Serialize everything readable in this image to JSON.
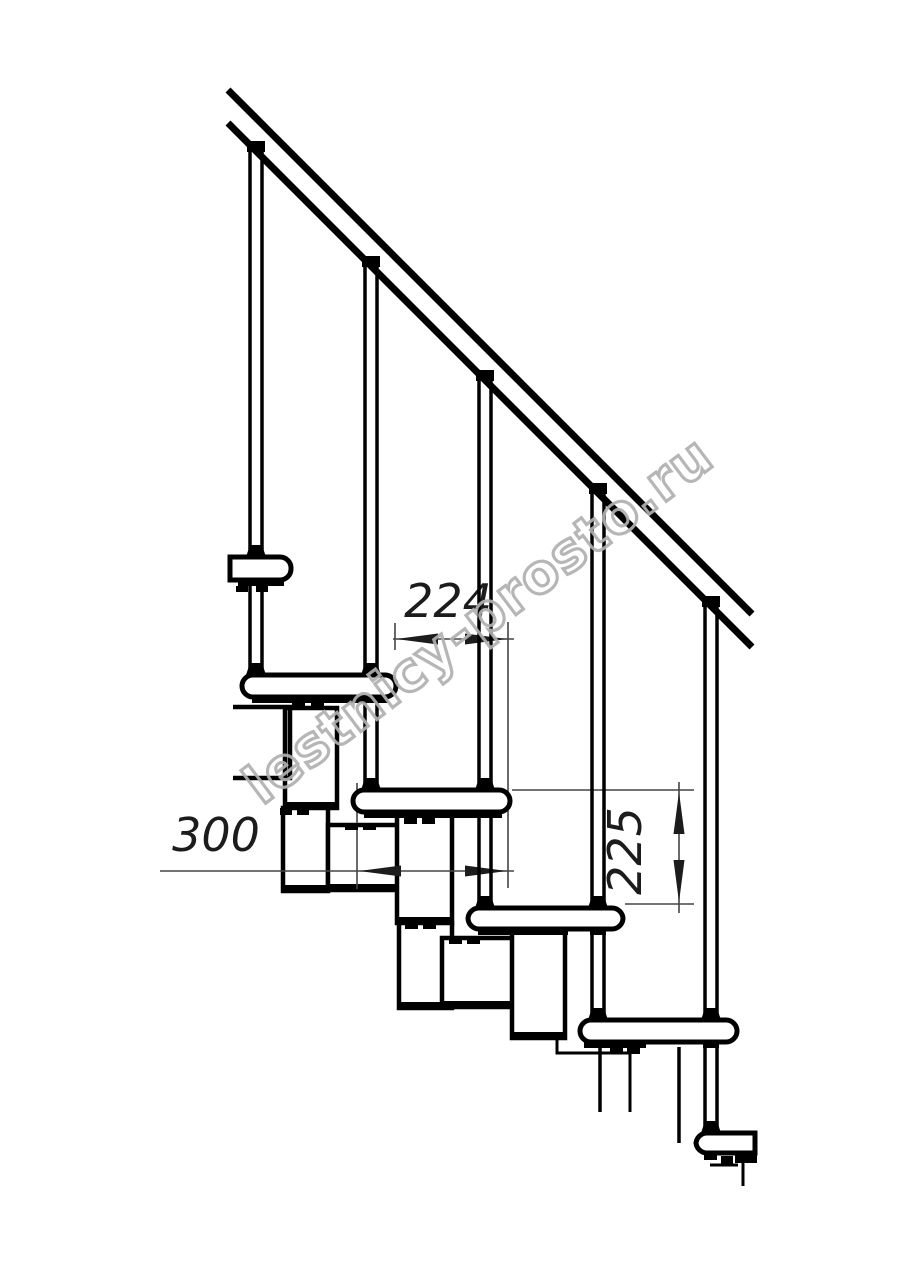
{
  "page": {
    "background": "#ffffff",
    "line_color": "#000000",
    "dim_line_color": "#454545",
    "description": "Side-view technical drawing of a modular staircase with handrail, balusters, treads and support modules"
  },
  "watermark": {
    "text": "lestnicy-prosto.ru",
    "color": "#b0b0b0",
    "x": 262,
    "y": 806,
    "angle_deg": -37,
    "font_size": 54
  },
  "dimensions": [
    {
      "id": "dim-224",
      "label": "224",
      "orientation": "horizontal",
      "text_x": 448,
      "text_y": 617,
      "rotate": 0,
      "lines": [
        [
          393,
          639,
          514,
          639
        ]
      ],
      "ext": [
        [
          395,
          623,
          395,
          650
        ],
        [
          508,
          622,
          508,
          888
        ]
      ],
      "arrows": [
        {
          "x": 396,
          "y": 639,
          "dir": "left"
        },
        {
          "x": 507,
          "y": 639,
          "dir": "right"
        }
      ]
    },
    {
      "id": "dim-300",
      "label": "300",
      "orientation": "horizontal",
      "text_x": 216,
      "text_y": 851,
      "rotate": 0,
      "lines": [
        [
          160,
          871,
          514,
          871
        ]
      ],
      "ext": [
        [
          357,
          783,
          357,
          889
        ]
      ],
      "arrows": [
        {
          "x": 359,
          "y": 871,
          "dir": "left"
        },
        {
          "x": 507,
          "y": 871,
          "dir": "right"
        }
      ]
    },
    {
      "id": "dim-225",
      "label": "225",
      "orientation": "vertical",
      "text_x": 641,
      "text_y": 851,
      "rotate": -90,
      "lines": [
        [
          679,
          782,
          679,
          913
        ]
      ],
      "ext": [
        [
          512,
          790,
          694,
          790
        ],
        [
          625,
          904,
          694,
          904
        ]
      ],
      "arrows": [
        {
          "x": 679,
          "y": 792,
          "dir": "up"
        },
        {
          "x": 679,
          "y": 902,
          "dir": "down"
        }
      ]
    }
  ],
  "drawing": {
    "rail": {
      "x1": 228,
      "y_top1": 90,
      "x2": 752,
      "y_top2": 614,
      "band_offset": 33,
      "stroke": 7
    },
    "balusters": [
      {
        "axis": 256,
        "rail_y": 151,
        "seg1_bot": 557,
        "seg2_top": 580,
        "seg2_bot": 675
      },
      {
        "axis": 371,
        "rail_y": 266,
        "seg1_bot": 675,
        "seg2_top": 697,
        "seg2_bot": 790
      },
      {
        "axis": 485,
        "rail_y": 380,
        "seg1_bot": 790,
        "seg2_top": 812,
        "seg2_bot": 908
      },
      {
        "axis": 598,
        "rail_y": 493,
        "seg1_bot": 908,
        "seg2_top": 929,
        "seg2_bot": 1020
      },
      {
        "axis": 711,
        "rail_y": 606,
        "seg1_bot": 1020,
        "seg2_top": 1042,
        "seg2_bot": 1133
      }
    ],
    "treads": [
      {
        "x": 230,
        "y": 557,
        "w": 61,
        "h": 23,
        "round": "right"
      },
      {
        "x": 242,
        "y": 675,
        "w": 154,
        "h": 22,
        "round": "both"
      },
      {
        "x": 353,
        "y": 790,
        "w": 157,
        "h": 22,
        "round": "both"
      },
      {
        "x": 468,
        "y": 908,
        "w": 155,
        "h": 21,
        "round": "both"
      },
      {
        "x": 580,
        "y": 1020,
        "w": 157,
        "h": 22,
        "round": "both"
      },
      {
        "x": 696,
        "y": 1133,
        "w": 59,
        "h": 20,
        "round": "left"
      }
    ],
    "modules": [
      {
        "x": 285,
        "y": 708,
        "w": 52,
        "h": 100
      },
      {
        "x": 283,
        "y": 808,
        "w": 45,
        "h": 83
      },
      {
        "x": 328,
        "y": 825,
        "w": 75,
        "h": 65
      },
      {
        "x": 397,
        "y": 815,
        "w": 55,
        "h": 108
      },
      {
        "x": 399,
        "y": 923,
        "w": 53,
        "h": 85
      },
      {
        "x": 442,
        "y": 938,
        "w": 76,
        "h": 69
      },
      {
        "x": 512,
        "y": 932,
        "w": 53,
        "h": 106
      }
    ],
    "open_paths": [
      {
        "pts": [
          [
            233,
            707
          ],
          [
            290,
            707
          ],
          [
            290,
            778
          ],
          [
            233,
            778
          ]
        ],
        "stroke": 4.5
      },
      {
        "pts": [
          [
            557,
            1040
          ],
          [
            557,
            1053
          ],
          [
            630,
            1053
          ],
          [
            630,
            1112
          ]
        ],
        "stroke": 3
      },
      {
        "pts": [
          [
            600,
            1047
          ],
          [
            600,
            1112
          ]
        ],
        "stroke": 3.5
      },
      {
        "pts": [
          [
            679,
            1047
          ],
          [
            679,
            1143
          ]
        ],
        "stroke": 3.5
      },
      {
        "pts": [
          [
            710,
            1165
          ],
          [
            738,
            1165
          ]
        ],
        "stroke": 3
      },
      {
        "pts": [
          [
            743,
            1163
          ],
          [
            743,
            1186
          ]
        ],
        "stroke": 3
      }
    ],
    "bands": [
      {
        "x": 238,
        "y": 580,
        "w": 46,
        "h": 6
      },
      {
        "x": 252,
        "y": 697,
        "w": 136,
        "h": 6
      },
      {
        "x": 364,
        "y": 812,
        "w": 138,
        "h": 6
      },
      {
        "x": 478,
        "y": 929,
        "w": 90,
        "h": 6
      },
      {
        "x": 584,
        "y": 1042,
        "w": 62,
        "h": 6
      },
      {
        "x": 735,
        "y": 1152,
        "w": 22,
        "h": 11
      }
    ],
    "nubs": [
      {
        "x": 236,
        "y": 586,
        "w": 12,
        "h": 6
      },
      {
        "x": 256,
        "y": 586,
        "w": 12,
        "h": 6
      },
      {
        "x": 292,
        "y": 703,
        "w": 13,
        "h": 6
      },
      {
        "x": 311,
        "y": 703,
        "w": 13,
        "h": 6
      },
      {
        "x": 280,
        "y": 808,
        "w": 12,
        "h": 7
      },
      {
        "x": 297,
        "y": 808,
        "w": 12,
        "h": 7
      },
      {
        "x": 345,
        "y": 823,
        "w": 13,
        "h": 7
      },
      {
        "x": 363,
        "y": 823,
        "w": 13,
        "h": 7
      },
      {
        "x": 404,
        "y": 818,
        "w": 13,
        "h": 6
      },
      {
        "x": 422,
        "y": 818,
        "w": 13,
        "h": 6
      },
      {
        "x": 405,
        "y": 923,
        "w": 13,
        "h": 6
      },
      {
        "x": 423,
        "y": 923,
        "w": 13,
        "h": 6
      },
      {
        "x": 449,
        "y": 938,
        "w": 13,
        "h": 6
      },
      {
        "x": 467,
        "y": 938,
        "w": 13,
        "h": 6
      },
      {
        "x": 519,
        "y": 929,
        "w": 13,
        "h": 6
      },
      {
        "x": 537,
        "y": 929,
        "w": 13,
        "h": 6
      },
      {
        "x": 610,
        "y": 1048,
        "w": 13,
        "h": 6
      },
      {
        "x": 627,
        "y": 1048,
        "w": 13,
        "h": 6
      },
      {
        "x": 704,
        "y": 1153,
        "w": 13,
        "h": 7
      },
      {
        "x": 721,
        "y": 1156,
        "w": 12,
        "h": 8
      }
    ]
  }
}
